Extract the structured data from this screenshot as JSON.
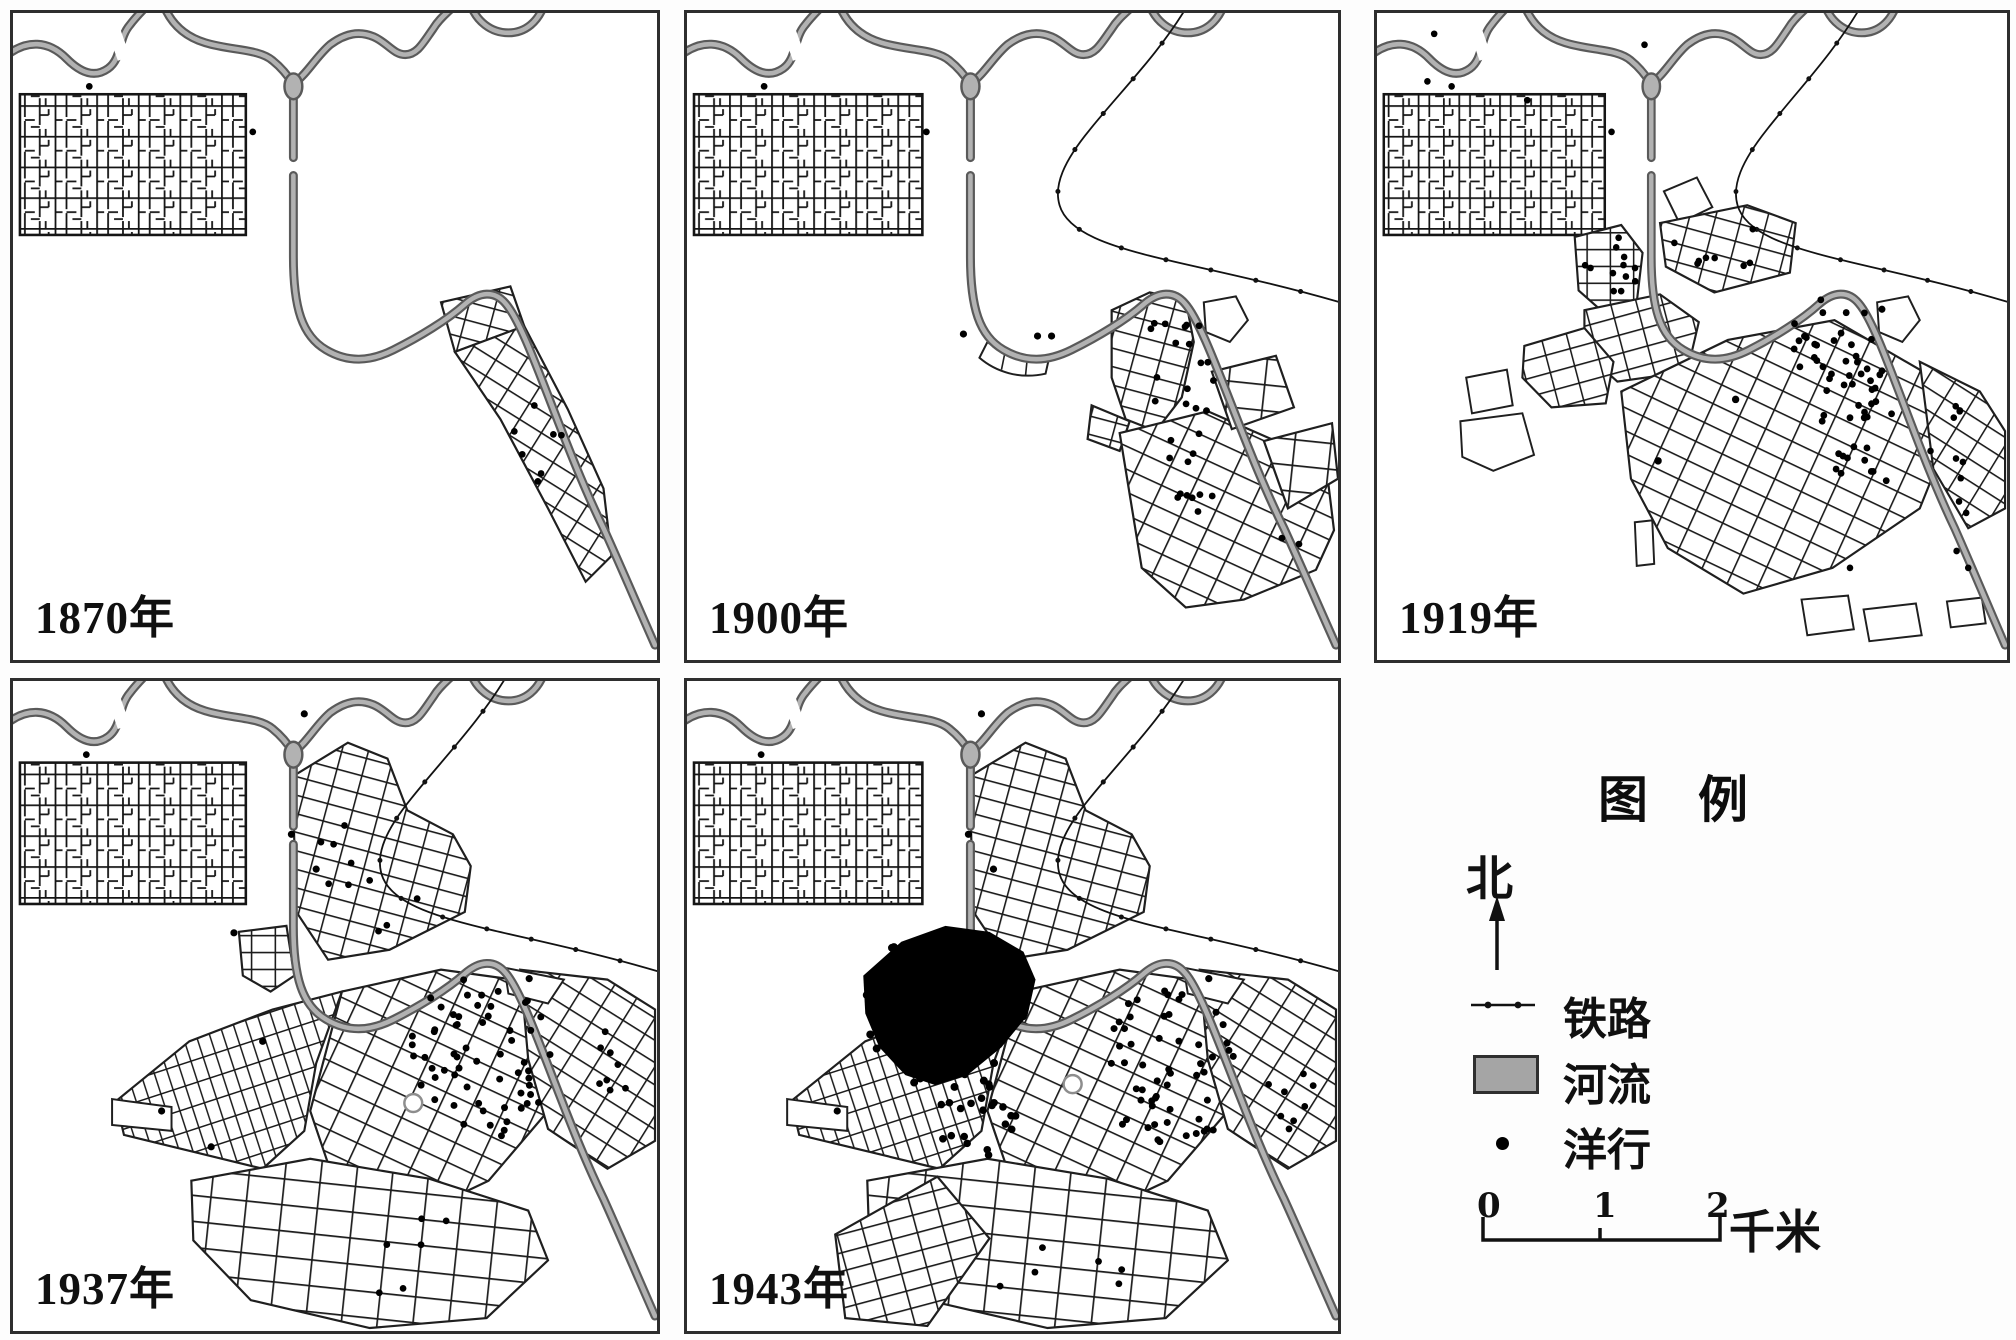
{
  "panels": [
    {
      "year_label": "1870年"
    },
    {
      "year_label": "1900年"
    },
    {
      "year_label": "1919年"
    },
    {
      "year_label": "1937年"
    },
    {
      "year_label": "1943年"
    }
  ],
  "legend": {
    "title": "图　例",
    "north_label": "北",
    "items": [
      {
        "icon": "railway-line-symbol",
        "label": "铁路"
      },
      {
        "icon": "river-swatch",
        "label": "河流"
      },
      {
        "icon": "firm-dot",
        "label": "洋行"
      }
    ],
    "scale_bar": {
      "ticks": [
        "0",
        "1",
        "2"
      ],
      "unit": "千米"
    }
  },
  "colors": {
    "river_fill": "#b2b2b2",
    "river_edge": "#5a5a5a",
    "map_ink": "#1f1f1f",
    "panel_border": "#2e2e2e",
    "firm_dot": "#000000",
    "legend_river_fill": "#a5a5a5"
  }
}
